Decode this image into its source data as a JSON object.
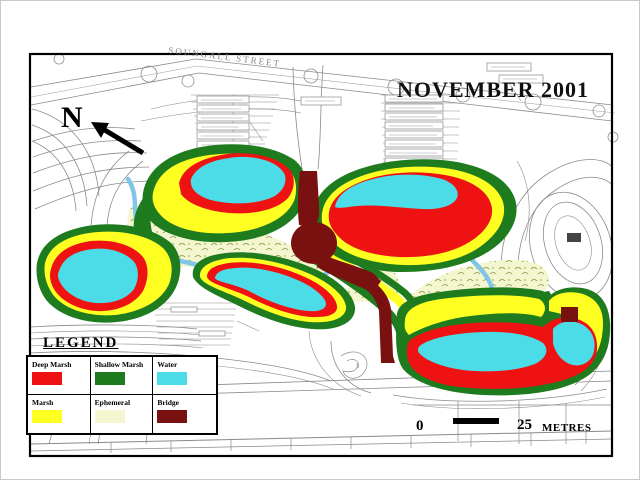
{
  "header": {
    "title": "NOVEMBER 2001"
  },
  "map": {
    "street_label": "SOUNGALL STREET",
    "north_label": "N",
    "icons": {
      "north_arrow": "north-arrow"
    },
    "colors": {
      "deep_marsh": "#ee1212",
      "shallow_marsh": "#1e7b1e",
      "water": "#4cdce8",
      "marsh": "#ffff22",
      "ephemeral": "#f4f6cf",
      "bridge": "#7a1111",
      "creek": "#7fc6e8",
      "linework": "#8a8a8a"
    }
  },
  "legend": {
    "title": "LEGEND",
    "items": [
      {
        "label": "Deep Marsh",
        "color": "#ee1212"
      },
      {
        "label": "Shallow Marsh",
        "color": "#1e7b1e"
      },
      {
        "label": "Water",
        "color": "#4cdce8"
      },
      {
        "label": "Marsh",
        "color": "#ffff22"
      },
      {
        "label": "Ephemeral",
        "color": "#f4f6cf"
      },
      {
        "label": "Bridge",
        "color": "#7a1111"
      }
    ]
  },
  "scale_bar": {
    "zero_label": "0",
    "distance_label": "25",
    "unit_label": "METRES"
  }
}
